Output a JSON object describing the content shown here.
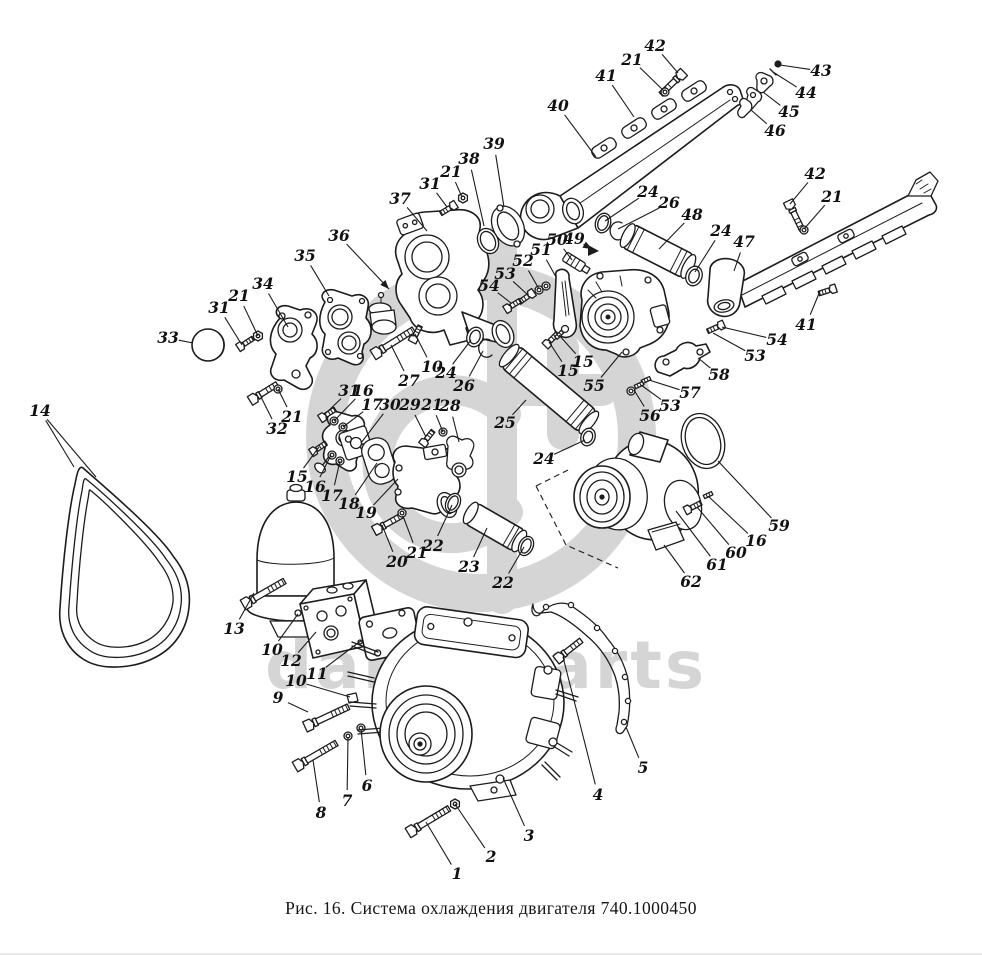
{
  "figure": {
    "caption": "Рис. 16. Система охлаждения двигателя 740.1000450",
    "figure_number": "16",
    "part_code": "740.1000450"
  },
  "watermark": {
    "word_left": "daru",
    "word_right": "parts"
  },
  "style": {
    "line_color": "#1c1c1c",
    "paper_color": "#ffffff",
    "watermark_color": "#d6d6d6"
  },
  "callouts": [
    {
      "label": "1",
      "x": 457,
      "y": 874,
      "tx": 426,
      "ty": 822
    },
    {
      "label": "2",
      "x": 491,
      "y": 857,
      "tx": 455,
      "ty": 804
    },
    {
      "label": "3",
      "x": 529,
      "y": 836,
      "tx": 503,
      "ty": 778
    },
    {
      "label": "4",
      "x": 598,
      "y": 795,
      "tx": 563,
      "ty": 657
    },
    {
      "label": "5",
      "x": 643,
      "y": 768,
      "tx": 626,
      "ty": 727
    },
    {
      "label": "6",
      "x": 367,
      "y": 786,
      "tx": 361,
      "ty": 729
    },
    {
      "label": "7",
      "x": 347,
      "y": 801,
      "tx": 348,
      "ty": 737
    },
    {
      "label": "8",
      "x": 321,
      "y": 813,
      "tx": 313,
      "ty": 760
    },
    {
      "label": "9",
      "x": 278,
      "y": 698,
      "tx": 308,
      "ty": 712
    },
    {
      "label": "10",
      "x": 272,
      "y": 650,
      "tx": 298,
      "ty": 614
    },
    {
      "label": "10",
      "x": 296,
      "y": 681,
      "tx": 350,
      "ty": 697
    },
    {
      "label": "11",
      "x": 317,
      "y": 674,
      "tx": 362,
      "ty": 640
    },
    {
      "label": "12",
      "x": 291,
      "y": 661,
      "tx": 316,
      "ty": 632
    },
    {
      "label": "13",
      "x": 234,
      "y": 629,
      "tx": 254,
      "ty": 593
    },
    {
      "label": "14",
      "x": 40,
      "y": 411,
      "tx": 74,
      "ty": 467,
      "tx2": 96,
      "ty2": 477
    },
    {
      "label": "15",
      "x": 297,
      "y": 477,
      "tx": 319,
      "ty": 447
    },
    {
      "label": "16",
      "x": 315,
      "y": 487,
      "tx": 331,
      "ty": 455
    },
    {
      "label": "17",
      "x": 332,
      "y": 496,
      "tx": 340,
      "ty": 461
    },
    {
      "label": "18",
      "x": 349,
      "y": 504,
      "tx": 377,
      "ty": 463
    },
    {
      "label": "19",
      "x": 366,
      "y": 513,
      "tx": 398,
      "ty": 479
    },
    {
      "label": "20",
      "x": 397,
      "y": 562,
      "tx": 382,
      "ty": 525
    },
    {
      "label": "21",
      "x": 417,
      "y": 553,
      "tx": 403,
      "ty": 516
    },
    {
      "label": "22",
      "x": 433,
      "y": 546,
      "tx": 452,
      "ty": 505
    },
    {
      "label": "23",
      "x": 469,
      "y": 567,
      "tx": 487,
      "ty": 528
    },
    {
      "label": "22",
      "x": 503,
      "y": 583,
      "tx": 524,
      "ty": 547
    },
    {
      "label": "24",
      "x": 446,
      "y": 373,
      "tx": 471,
      "ty": 340
    },
    {
      "label": "26",
      "x": 464,
      "y": 386,
      "tx": 483,
      "ty": 351
    },
    {
      "label": "25",
      "x": 505,
      "y": 423,
      "tx": 526,
      "ty": 400
    },
    {
      "label": "24",
      "x": 544,
      "y": 459,
      "tx": 585,
      "ty": 440
    },
    {
      "label": "27",
      "x": 409,
      "y": 381,
      "tx": 391,
      "ty": 345
    },
    {
      "label": "10",
      "x": 432,
      "y": 367,
      "tx": 415,
      "ty": 334
    },
    {
      "label": "31",
      "x": 349,
      "y": 391,
      "tx": 325,
      "ty": 414
    },
    {
      "label": "16",
      "x": 363,
      "y": 391,
      "tx": 334,
      "ty": 421
    },
    {
      "label": "17",
      "x": 372,
      "y": 405,
      "tx": 343,
      "ty": 427
    },
    {
      "label": "30",
      "x": 390,
      "y": 405,
      "tx": 361,
      "ty": 443
    },
    {
      "label": "29",
      "x": 410,
      "y": 405,
      "tx": 426,
      "ty": 437
    },
    {
      "label": "21",
      "x": 432,
      "y": 405,
      "tx": 443,
      "ty": 432
    },
    {
      "label": "28",
      "x": 450,
      "y": 406,
      "tx": 459,
      "ty": 442
    },
    {
      "label": "31",
      "x": 430,
      "y": 184,
      "tx": 447,
      "ty": 207
    },
    {
      "label": "21",
      "x": 451,
      "y": 172,
      "tx": 462,
      "ty": 197
    },
    {
      "label": "37",
      "x": 400,
      "y": 199,
      "tx": 427,
      "ty": 231
    },
    {
      "label": "38",
      "x": 469,
      "y": 159,
      "tx": 484,
      "ty": 226
    },
    {
      "label": "39",
      "x": 494,
      "y": 144,
      "tx": 504,
      "ty": 207
    },
    {
      "label": "36",
      "x": 339,
      "y": 236,
      "tx": 389,
      "ty": 289,
      "arrow": true
    },
    {
      "label": "35",
      "x": 305,
      "y": 256,
      "tx": 329,
      "ty": 296
    },
    {
      "label": "34",
      "x": 263,
      "y": 284,
      "tx": 288,
      "ty": 327
    },
    {
      "label": "31",
      "x": 219,
      "y": 308,
      "tx": 242,
      "ty": 345
    },
    {
      "label": "21",
      "x": 239,
      "y": 296,
      "tx": 258,
      "ty": 336
    },
    {
      "label": "33",
      "x": 168,
      "y": 338,
      "tx": 193,
      "ty": 343
    },
    {
      "label": "32",
      "x": 277,
      "y": 429,
      "tx": 261,
      "ty": 397
    },
    {
      "label": "21",
      "x": 292,
      "y": 417,
      "tx": 278,
      "ty": 389
    },
    {
      "label": "40",
      "x": 558,
      "y": 106,
      "tx": 596,
      "ty": 157
    },
    {
      "label": "41",
      "x": 606,
      "y": 76,
      "tx": 634,
      "ty": 117
    },
    {
      "label": "21",
      "x": 632,
      "y": 60,
      "tx": 664,
      "ty": 91
    },
    {
      "label": "42",
      "x": 655,
      "y": 46,
      "tx": 678,
      "ty": 73
    },
    {
      "label": "43",
      "x": 821,
      "y": 71,
      "tx": 780,
      "ty": 65
    },
    {
      "label": "44",
      "x": 806,
      "y": 93,
      "tx": 773,
      "ty": 72
    },
    {
      "label": "45",
      "x": 789,
      "y": 112,
      "tx": 763,
      "ty": 92
    },
    {
      "label": "46",
      "x": 775,
      "y": 131,
      "tx": 751,
      "ty": 110
    },
    {
      "label": "42",
      "x": 815,
      "y": 174,
      "tx": 790,
      "ty": 204
    },
    {
      "label": "21",
      "x": 832,
      "y": 197,
      "tx": 804,
      "ty": 229
    },
    {
      "label": "47",
      "x": 744,
      "y": 242,
      "tx": 734,
      "ty": 271
    },
    {
      "label": "24",
      "x": 721,
      "y": 231,
      "tx": 695,
      "ty": 272
    },
    {
      "label": "41",
      "x": 806,
      "y": 325,
      "tx": 820,
      "ty": 291
    },
    {
      "label": "54",
      "x": 777,
      "y": 340,
      "tx": 722,
      "ty": 327
    },
    {
      "label": "53",
      "x": 755,
      "y": 356,
      "tx": 713,
      "ty": 333
    },
    {
      "label": "58",
      "x": 719,
      "y": 375,
      "tx": 698,
      "ty": 358
    },
    {
      "label": "57",
      "x": 690,
      "y": 393,
      "tx": 649,
      "ty": 380
    },
    {
      "label": "53",
      "x": 670,
      "y": 406,
      "tx": 641,
      "ty": 385
    },
    {
      "label": "56",
      "x": 650,
      "y": 416,
      "tx": 634,
      "ty": 390
    },
    {
      "label": "50",
      "x": 557,
      "y": 240,
      "tx": 572,
      "ty": 260
    },
    {
      "label": "49",
      "x": 574,
      "y": 239,
      "tx": 592,
      "ty": 249,
      "arrow": true
    },
    {
      "label": "51",
      "x": 541,
      "y": 250,
      "tx": 556,
      "ty": 277
    },
    {
      "label": "52",
      "x": 523,
      "y": 261,
      "tx": 539,
      "ty": 289
    },
    {
      "label": "53",
      "x": 505,
      "y": 274,
      "tx": 528,
      "ty": 295
    },
    {
      "label": "54",
      "x": 489,
      "y": 286,
      "tx": 511,
      "ty": 303
    },
    {
      "label": "24",
      "x": 648,
      "y": 192,
      "tx": 605,
      "ty": 221
    },
    {
      "label": "26",
      "x": 669,
      "y": 203,
      "tx": 618,
      "ty": 229
    },
    {
      "label": "48",
      "x": 692,
      "y": 215,
      "tx": 659,
      "ty": 249
    },
    {
      "label": "15",
      "x": 568,
      "y": 371,
      "tx": 549,
      "ty": 342
    },
    {
      "label": "15",
      "x": 583,
      "y": 362,
      "tx": 559,
      "ty": 335
    },
    {
      "label": "55",
      "x": 594,
      "y": 386,
      "tx": 622,
      "ty": 352
    },
    {
      "label": "59",
      "x": 779,
      "y": 526,
      "tx": 718,
      "ty": 461
    },
    {
      "label": "16",
      "x": 756,
      "y": 541,
      "tx": 708,
      "ty": 496
    },
    {
      "label": "60",
      "x": 736,
      "y": 553,
      "tx": 697,
      "ty": 507
    },
    {
      "label": "61",
      "x": 717,
      "y": 565,
      "tx": 676,
      "ty": 511
    },
    {
      "label": "62",
      "x": 691,
      "y": 582,
      "tx": 664,
      "ty": 545
    }
  ]
}
